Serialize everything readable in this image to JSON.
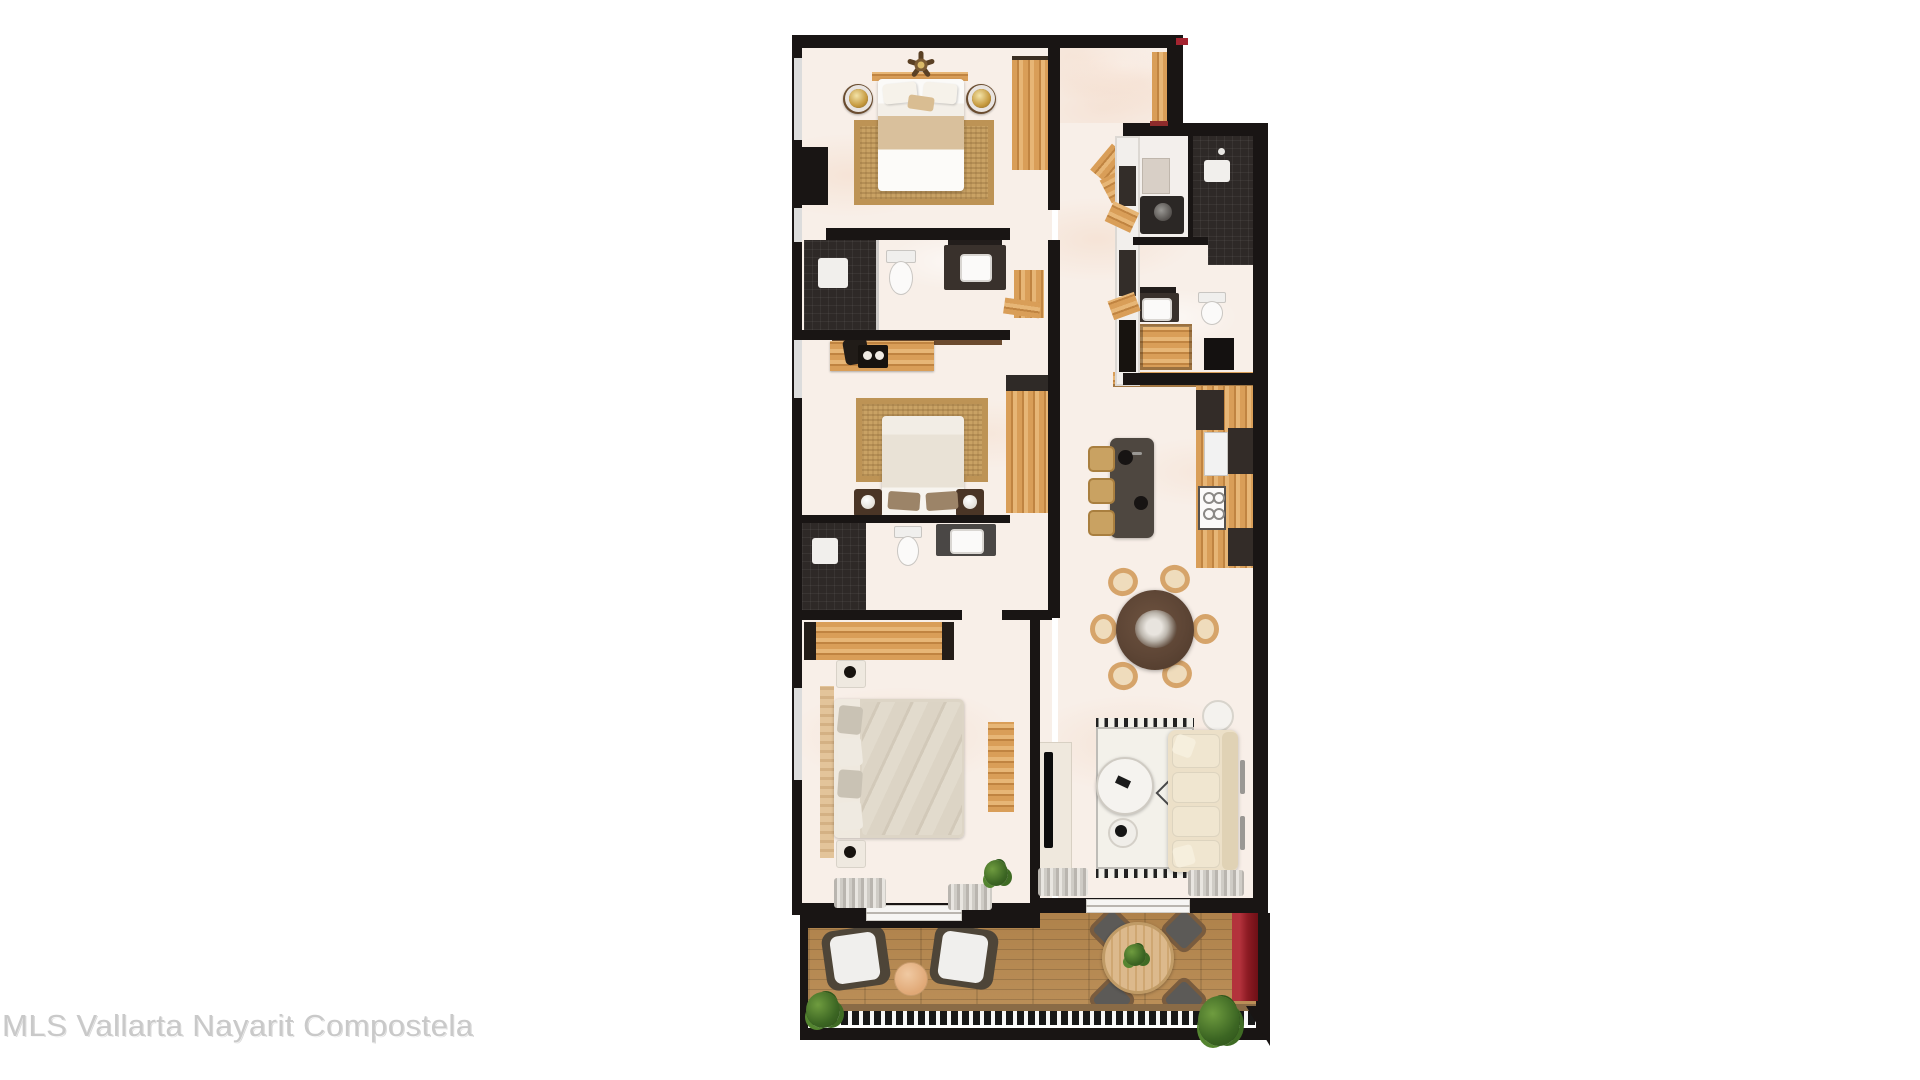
{
  "watermark": {
    "text": "MLS Vallarta Nayarit Compostela"
  },
  "palette": {
    "wall": "#191514",
    "marble": "#f8efe8",
    "wood": "#d99e58",
    "wood_dark": "#c08441",
    "jute": "#c9a264",
    "dark_tile": "#2e2927",
    "counter": "#39312c",
    "island": "#4e4740",
    "sofa_cream": "#ece0c8",
    "linen": "#fdfdfd",
    "deck_wood": "#b8894f",
    "accent_red": "#a42430",
    "terrace_chair": "#5c5a57",
    "watermark": "#c9c9c9",
    "table_brown": "#5d4535"
  }
}
